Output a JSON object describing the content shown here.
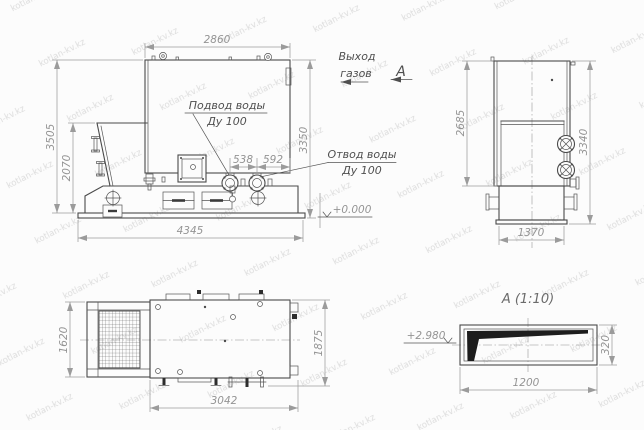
{
  "watermark": {
    "text": "kotlan-kv.kz"
  },
  "colors": {
    "line": "#4a4a4a",
    "dimension": "#9b9b9b",
    "label": "#4f4f4f",
    "background": "#fcfcfc",
    "watermark": "#dcdcdc",
    "wedge_fill": "#1d1d1d"
  },
  "front_view": {
    "dim_width_top": "2860",
    "dim_height_left": "3505",
    "dim_height_hopper": "2070",
    "dim_height_right": "3350",
    "dim_width_bottom": "4345",
    "dim_flange_left": "538",
    "dim_flange_right": "592",
    "label_water_supply_line1": "Подвод воды",
    "label_water_supply_line2": "Ду 100",
    "label_water_return_line1": "Отвод воды",
    "label_water_return_line2": "Ду 100",
    "label_level_zero": "+0.000"
  },
  "side_view": {
    "dim_height_left": "2685",
    "dim_height_right": "3340",
    "dim_width_bottom": "1370",
    "label_gas_exit_line1": "Выход",
    "label_gas_exit_line2": "газов",
    "section_letter": "А"
  },
  "plan_view": {
    "dim_height_left": "1620",
    "dim_height_right": "1875",
    "dim_width_bottom": "3042"
  },
  "detail_view": {
    "title": "А (1:10)",
    "dim_width_bottom": "1200",
    "dim_height_right": "320",
    "label_level": "+2.980"
  }
}
